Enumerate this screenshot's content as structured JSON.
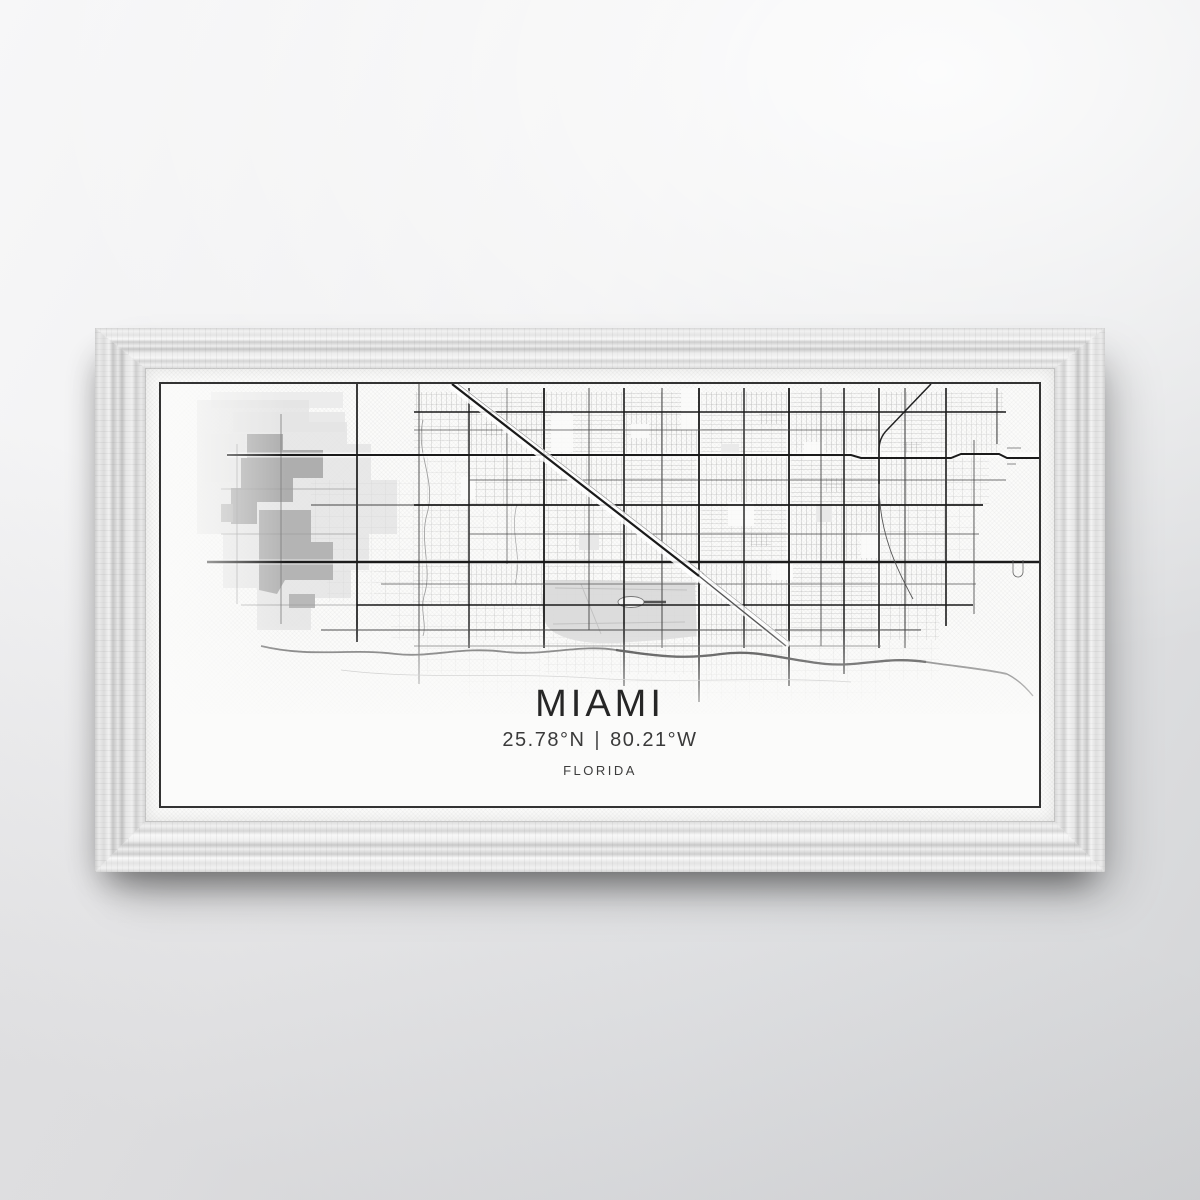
{
  "artwork": {
    "city": "MIAMI",
    "latitude": "25.78°N",
    "separator": "|",
    "longitude": "80.21°W",
    "state": "FLORIDA"
  },
  "colors": {
    "wall": "#e4e5e7",
    "frame_wood": "#eeeeee",
    "canvas": "#fbfbfa",
    "map_border": "#333333",
    "major_road": "#1b1b1b",
    "minor_road": "#8f8f8f",
    "district_gray": "#aeaeae",
    "airport_gray": "#dadada",
    "water_canal": "#6b6b6b",
    "title_text": "#262626"
  }
}
